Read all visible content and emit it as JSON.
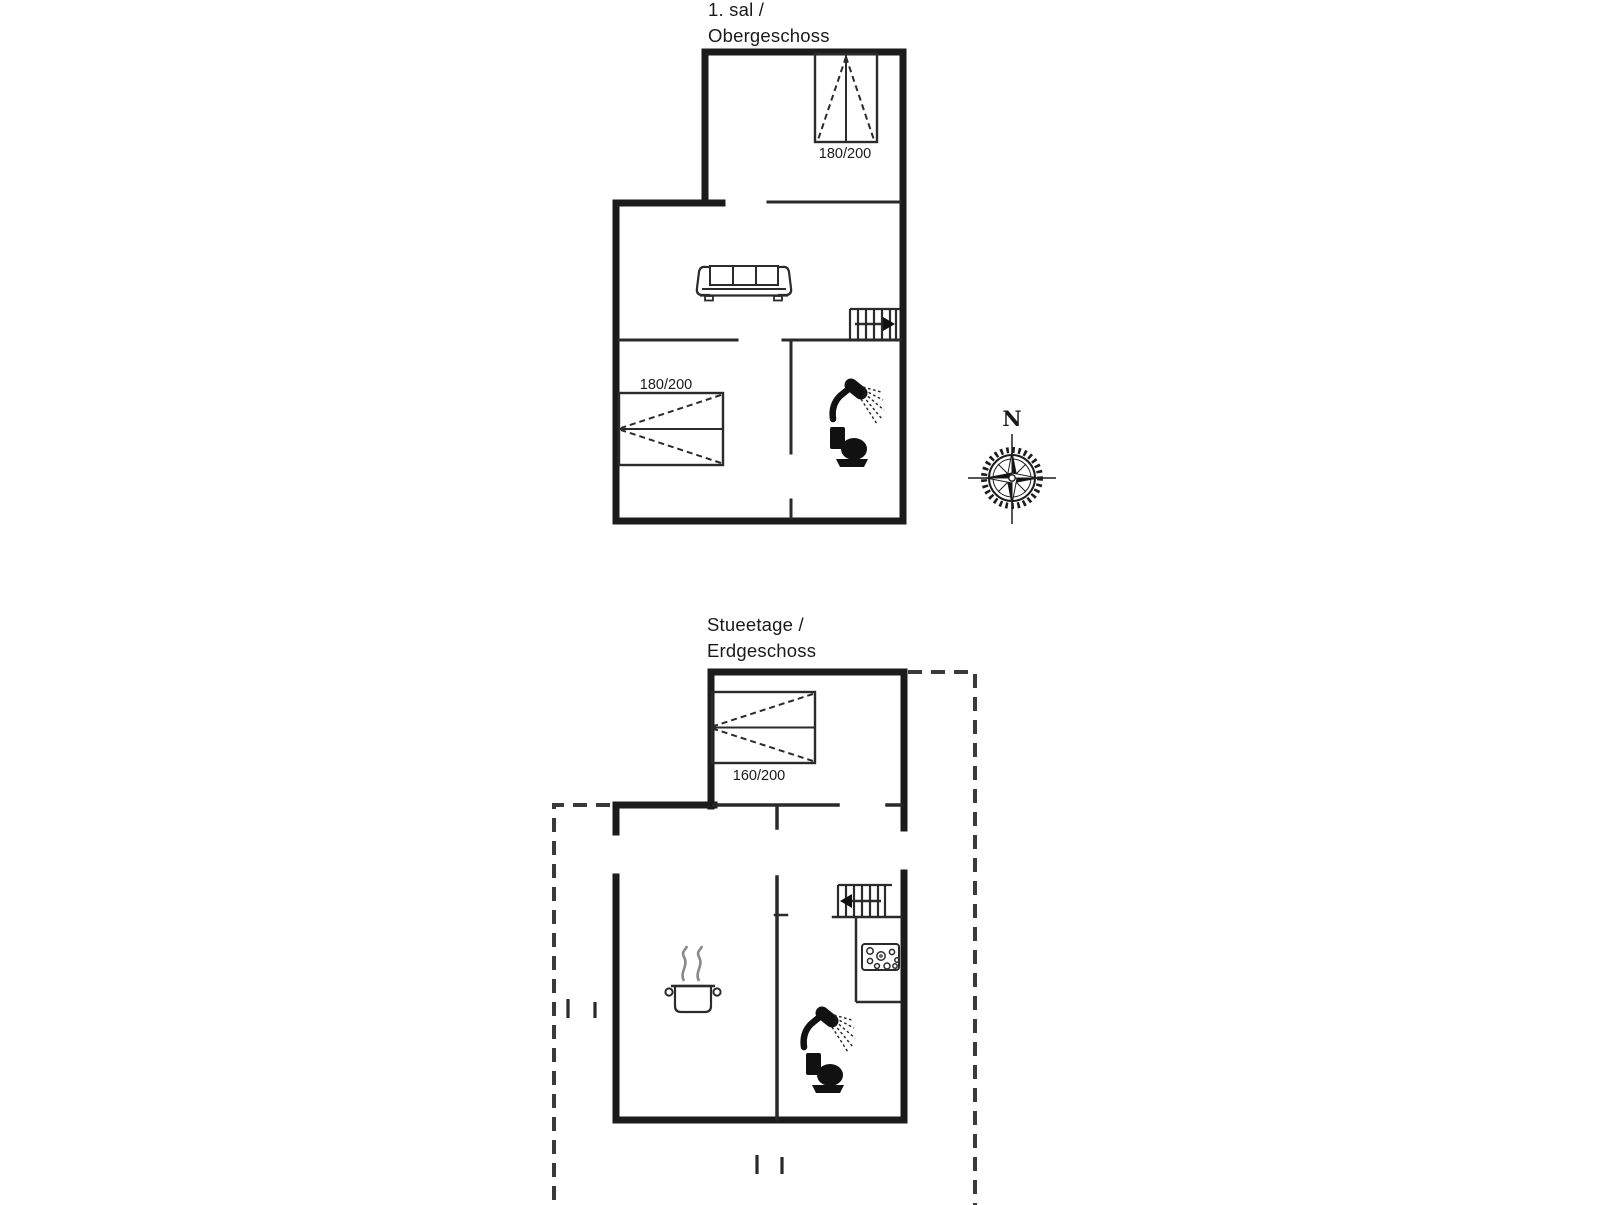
{
  "document": {
    "type": "floor-plan",
    "background": "#ffffff"
  },
  "colors": {
    "exterior_wall": "#1b1b1b",
    "interior_wall": "#2a2a2a",
    "furniture_line": "#2b2b2b",
    "dashed_outline": "#3a3a3a",
    "steam": "#8a8a8a",
    "text": "#1a1a1a"
  },
  "upper_floor": {
    "title_line1": "1. sal /",
    "title_line2": "Obergeschoss",
    "bed_top_label": "180/200",
    "bed_left_label": "180/200",
    "icons": [
      "double-bed",
      "double-bed",
      "sofa",
      "staircase-with-arrow-right",
      "shower-icon",
      "toilet-icon"
    ]
  },
  "ground_floor": {
    "title_line1": "Stueetage /",
    "title_line2": "Erdgeschoss",
    "bed_label": "160/200",
    "icons": [
      "double-bed",
      "staircase-with-arrow-left",
      "hob-icon",
      "cooking-pot-icon",
      "shower-icon",
      "toilet-icon"
    ],
    "terrace_outline_style": "dashed"
  },
  "compass": {
    "north_label": "N"
  }
}
